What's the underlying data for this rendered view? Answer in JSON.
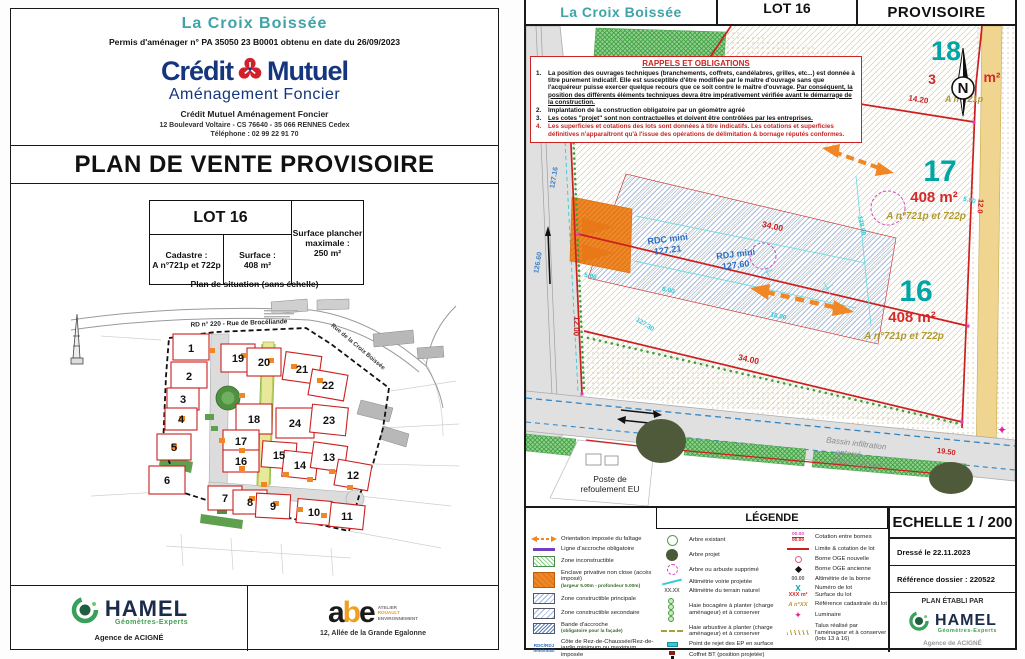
{
  "colors": {
    "teal_accent": "#3fa3a8",
    "lot_number_teal": "#00a5a5",
    "area_red": "#d42a2a",
    "cadastre_olive": "#b09a30",
    "lot_line_red": "#cc1f1f",
    "brand_blue": "#15357e",
    "brand_red": "#d21f2c",
    "orange": "#f08624",
    "hamel_green": "#3fa04f",
    "abe_orange": "#f0a020"
  },
  "left_page": {
    "project_name": "La Croix Boissée",
    "permit_line": "Permis d'aménager n° PA 35050 23 B0001 obtenu en date du 26/09/2023",
    "bank": {
      "brand_left": "Crédit",
      "brand_right": "Mutuel",
      "brand_sub": "Aménagement Foncier",
      "org_line": "Crédit Mutuel Aménagement Foncier",
      "address_line": "12 Boulevard Voltaire - CS 76640 - 35 066 RENNES Cedex",
      "phone_line": "Téléphone : 02 99 22 91 70"
    },
    "title": "PLAN DE VENTE PROVISOIRE",
    "lot_table": {
      "lot": "LOT 16",
      "cadastre_label": "Cadastre :",
      "cadastre_value": "A n°721p et 722p",
      "surface_label": "Surface :",
      "surface_value": "408 m²",
      "floor_label": "Surface plancher maximale :",
      "floor_value": "250 m²"
    },
    "situation_caption": "Plan de situation (sans échelle)",
    "map": {
      "road_label": "RD  n° 220 - Rue de Brocéliande",
      "street_label": "Rue de la Croix Boissée",
      "lots": [
        "1",
        "2",
        "3",
        "4",
        "5",
        "6",
        "7",
        "8",
        "9",
        "10",
        "11",
        "12",
        "13",
        "14",
        "15",
        "16",
        "17",
        "18",
        "19",
        "20",
        "21",
        "22",
        "23",
        "24"
      ]
    },
    "footer": {
      "hamel_name": "HAMEL",
      "hamel_sub": "Géomètres-Experts",
      "hamel_agency": "Agence de ACIGNÉ",
      "abe_a": "a",
      "abe_b": "b",
      "abe_e": "e",
      "abe_line1": "ATELIER",
      "abe_line2": "ROUAULT",
      "abe_line3": "ENVIRONNEMENT",
      "abe_address": "12, Allée de la Grande Egalonne"
    }
  },
  "right_page": {
    "header": {
      "project": "La Croix Boissée",
      "lot": "LOT 16",
      "status": "PROVISOIRE"
    },
    "rappels": {
      "title": "RAPPELS ET OBLIGATIONS",
      "item1": {
        "num": "1.",
        "text_a": "La position des ouvrages techniques (branchements, coffrets, candélabres, grilles, etc...) est donnée à titre purement indicatif. Elle est susceptible d'être modifiée par le maître d'ouvrage sans que l'acquéreur puisse exercer quelque recours que ce soit contre le maître d'ouvrage.",
        "text_b": "Par conséquent, la position des différents éléments techniques devra être impérativement vérifiée avant le démarrage de la construction."
      },
      "item2": {
        "num": "2.",
        "text": "Implantation de la construction obligatoire par un géomètre agréé"
      },
      "item3": {
        "num": "3.",
        "text": "Les cotes \"projet\" sont non contractuelles et doivent être contrôlées par les entreprises."
      },
      "item4": {
        "num": "4.",
        "text": "Les superficies et cotations des lots sont données à titre indicatifs. Les cotations et superficies définitives n'apparaîtront qu'à l'issue des opérations de délimitation & bornage réputés conformes."
      }
    },
    "plan": {
      "lot18": {
        "num": "18",
        "area_prefix": "3",
        "area_suffix": "m²",
        "cadastre": "A n°721p"
      },
      "lot17": {
        "num": "17",
        "area": "408 m²",
        "cadastre": "A n°721p et 722p"
      },
      "lot16": {
        "num": "16",
        "area": "408 m²",
        "cadastre": "A n°721p et 722p"
      },
      "rdc_label": "RDC mini",
      "rdc_value": "127.21",
      "rdj_label": "RDJ mini",
      "rdj_value": "127.60",
      "north_letter": "N",
      "dims": {
        "d1420": "14.20",
        "d3400": "34.00",
        "d1200": "12.00",
        "d120": "12.0",
        "d500": "5.00",
        "d600": "6.00",
        "d1800": "18.00",
        "d1950": "19.50",
        "alt1": "127.16",
        "alt2": "126.60",
        "alt3": "128.00",
        "alt4": "127.30"
      },
      "poste": {
        "l1": "Poste de",
        "l2": "refoulement EU"
      },
      "bassin": {
        "l1": "Bassin infiltration",
        "l2": "enterré",
        "l3": "18m³ / 120 m²"
      }
    },
    "legend": {
      "title": "LÉGENDE",
      "col1": [
        {
          "label": "Orientation imposée du faîtage"
        },
        {
          "label": "Ligne d'accroche obligatoire"
        },
        {
          "label": "Zone inconstructible"
        },
        {
          "label": "Enclave privative non close (accès imposé)",
          "sub": "(largeur 5.00m - profondeur 5.00m)"
        },
        {
          "label": "Zone constructible principale"
        },
        {
          "label": "Zone constructible secondaire"
        },
        {
          "label": "Bande d'accroche",
          "sub": "(obligatoire pour la façade)"
        },
        {
          "icon_line1": "RDC/RDJ",
          "icon_line2": "mini/maxi",
          "label": "Côte de Rez-de-Chaussée/Rez-de-jardin minimum ou maximum imposée"
        }
      ],
      "col2": [
        {
          "label": "Arbre existant"
        },
        {
          "label": "Arbre projet"
        },
        {
          "label": "Arbre ou arbuste supprimé"
        },
        {
          "label": "Altimétrie voirie projetée"
        },
        {
          "icon_text": "XX.XX",
          "label": "Altimétrie du terrain naturel"
        },
        {
          "label": "Haie bocagère à planter (charge aménageur) et à conserver"
        },
        {
          "label": "Haie arbustive à planter (charge aménageur) et à conserver"
        },
        {
          "label": "Point de rejet des EP en surface"
        },
        {
          "label": "Coffret BT (position projetée)"
        }
      ],
      "col3": [
        {
          "icon_line1": "00.00",
          "icon_line2": "00.00",
          "label": "Cotation entre bornes"
        },
        {
          "label": "Limite & cotation de lot"
        },
        {
          "label": "Borne OGE nouvelle"
        },
        {
          "label": "Borne OGE ancienne"
        },
        {
          "icon_text": "00.00",
          "label": "Altimétrie de la borne"
        },
        {
          "icon_line1": "X",
          "icon_line2": "XXX m²",
          "label1": "Numéro de lot",
          "label2": "Surface du lot"
        },
        {
          "icon_text": "A n°XX",
          "label": "Référence cadastrale du lot"
        },
        {
          "label": "Luminaire"
        },
        {
          "label": "Talus réalisé par l'aménageur et à conserver (lots 13 à 16)"
        }
      ]
    },
    "cartouche": {
      "scale": "ECHELLE 1 / 200",
      "date": "Dressé le 22.11.2023",
      "ref": "Référence dossier : 220522",
      "established": "PLAN ÉTABLI PAR",
      "hamel_name": "HAMEL",
      "hamel_sub": "Géomètres-Experts",
      "agency": "Agence de ACIGNÉ"
    }
  }
}
